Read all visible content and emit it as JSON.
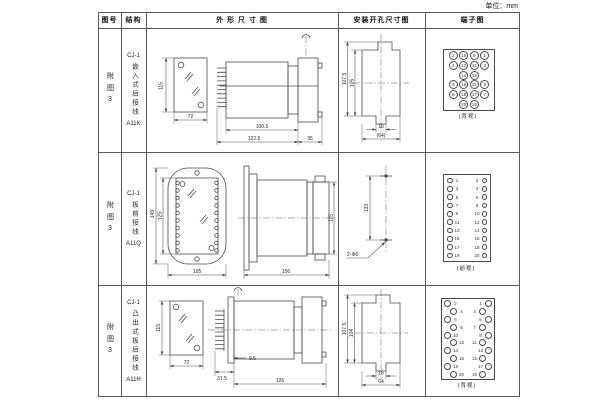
{
  "page": {
    "unit_label": "单位：mm"
  },
  "table": {
    "headers": {
      "figure_no": "图号",
      "structure": "结构",
      "outline": "外 形 尺 寸 图",
      "mounting": "安装开孔尺寸图",
      "terminal": "端子图"
    },
    "rows": [
      {
        "figure_no": "附图3",
        "structure": {
          "model": "CJ-1",
          "type_vertical": "嵌入式后接线",
          "code": "A11K"
        },
        "outline": {
          "front_height": "115",
          "front_width": "72",
          "side_body": "100.5",
          "side_total": "122.5",
          "side_flange": "35"
        },
        "mounting": {
          "outer_height": "107.5",
          "inner_height": "105",
          "slot_width": "16",
          "outer_width": "(64)"
        },
        "terminal": {
          "layout": "grid",
          "caption": "(背视)",
          "grid": [
            [
              "2",
              "10",
              "9",
              "1"
            ],
            [
              "4",
              "12",
              "11",
              "3"
            ],
            [
              "",
              "14",
              "13",
              ""
            ],
            [
              "6",
              "16",
              "15",
              "5"
            ],
            [
              "8",
              "18",
              "17",
              "7"
            ],
            [
              "",
              "20",
              "19",
              ""
            ]
          ]
        }
      },
      {
        "figure_no": "附图3",
        "structure": {
          "model": "CJ-1",
          "type_vertical": "板前接线",
          "code": "A11Q"
        },
        "outline": {
          "front_outer_height": "149",
          "front_inner_height": "125",
          "front_width": "105",
          "side_length": "156",
          "side_height": "115"
        },
        "mounting": {
          "hole_distance": "133",
          "hole_label": "2-Φ6"
        },
        "terminal": {
          "layout": "columns",
          "caption": "(前视)",
          "pairs": [
            [
              "1",
              "2"
            ],
            [
              "3",
              "4"
            ],
            [
              "5",
              "6"
            ],
            [
              "7",
              "8"
            ],
            [
              "9",
              "10"
            ],
            [
              "11",
              "12"
            ],
            [
              "13",
              "14"
            ],
            [
              "15",
              "16"
            ],
            [
              "17",
              "18"
            ],
            [
              "19",
              "20"
            ]
          ]
        }
      },
      {
        "figure_no": "附图3",
        "structure": {
          "model": "CJ-1",
          "type_vertical": "凸出式板后接线",
          "code": "A11H"
        },
        "outline": {
          "front_height": "115",
          "front_width": "72",
          "side_plate": "31.5",
          "side_gap": "9.5",
          "side_length": "126"
        },
        "mounting": {
          "outer_height": "107.5",
          "inner_height": "104",
          "slot_width": "16",
          "outer_width": "64"
        },
        "terminal": {
          "layout": "studs",
          "caption": "(背视)",
          "pairs": [
            [
              "2",
              "1"
            ],
            [
              "4",
              "3"
            ],
            [
              "6",
              "5"
            ],
            [
              "8",
              "7"
            ],
            [
              "10",
              "9"
            ],
            [
              "12",
              "11"
            ],
            [
              "14",
              "13"
            ],
            [
              "16",
              "15"
            ],
            [
              "18",
              "17"
            ],
            [
              "20",
              "19"
            ]
          ]
        }
      }
    ]
  }
}
